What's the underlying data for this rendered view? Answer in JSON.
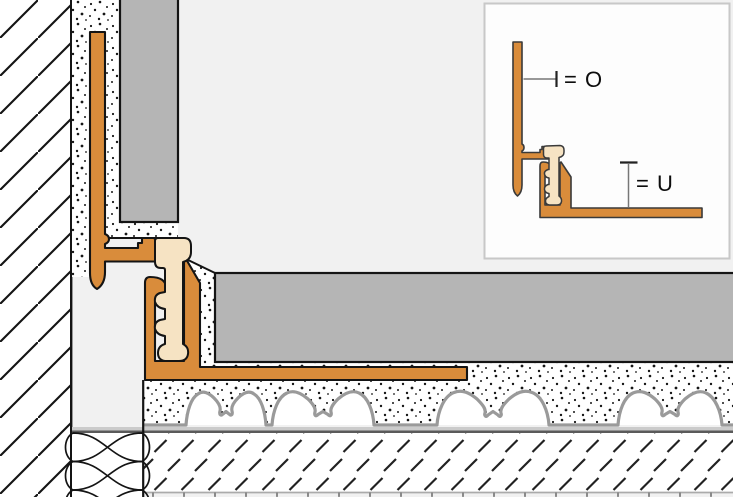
{
  "diagram": {
    "legend": {
      "upper_reference_label": "= O",
      "lower_reference_label": "= U"
    },
    "colors": {
      "profile_orange": "#D98C3B",
      "insert_cream": "#F6E3C3",
      "tile_gray": "#B5B5B5",
      "background_gray": "#F1F1F1",
      "speckle_white": "#FFFFFF",
      "membrane_gray": "#9A9A9A",
      "fleece_band_gray": "#CBCBCB",
      "dark_layer_line": "#5A5A5A",
      "outline_black": "#141414",
      "inset_background": "#FDFDFD",
      "inset_border": "#C8C8C8"
    }
  }
}
